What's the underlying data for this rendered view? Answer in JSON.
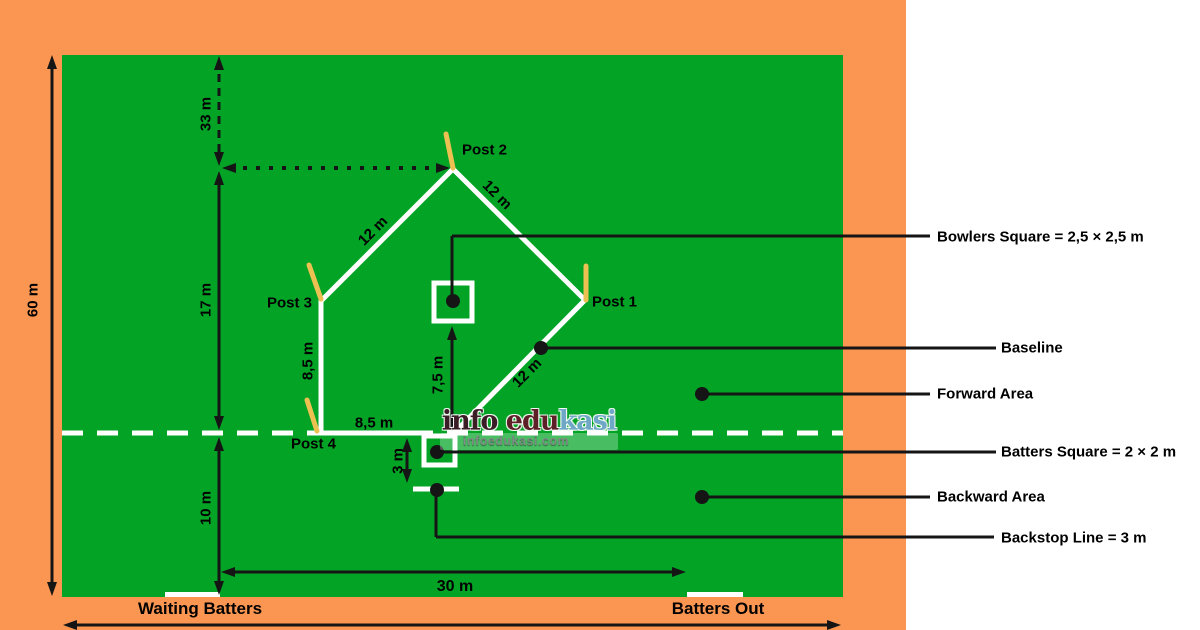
{
  "colors": {
    "margin_orange": "#FA9651",
    "field_green": "#03A426",
    "line_white": "#FFFFFF",
    "line_black": "#151515",
    "post_stick": "#EDC052"
  },
  "posts": {
    "p1": "Post 1",
    "p2": "Post 2",
    "p3": "Post 3",
    "p4": "Post 4"
  },
  "dimensions": {
    "field_height": "60 m",
    "top_offset": "33 m",
    "mid_segment": "17 m",
    "bottom_segment": "10 m",
    "edge_top_left": "12 m",
    "edge_top_right": "12 m",
    "edge_bottom_right": "12 m",
    "post3_to_post4": "8,5 m",
    "post4_to_batters": "8,5 m",
    "bowlers_to_batters": "7,5 m",
    "batters_to_backstop": "3 m",
    "bottom_span": "30 m"
  },
  "callouts": {
    "bowlers": "Bowlers Square = 2,5 × 2,5 m",
    "baseline": "Baseline",
    "forward": "Forward Area",
    "batters": "Batters Square = 2 × 2 m",
    "backward": "Backward Area",
    "backstop": "Backstop Line = 3 m"
  },
  "bottom_labels": {
    "waiting_batters": "Waiting Batters",
    "batters_out": "Batters Out"
  },
  "watermark": {
    "brand_part1": "info ",
    "brand_part2": "edu",
    "brand_part3": "kasi",
    "site": "infoedukasi.com"
  }
}
